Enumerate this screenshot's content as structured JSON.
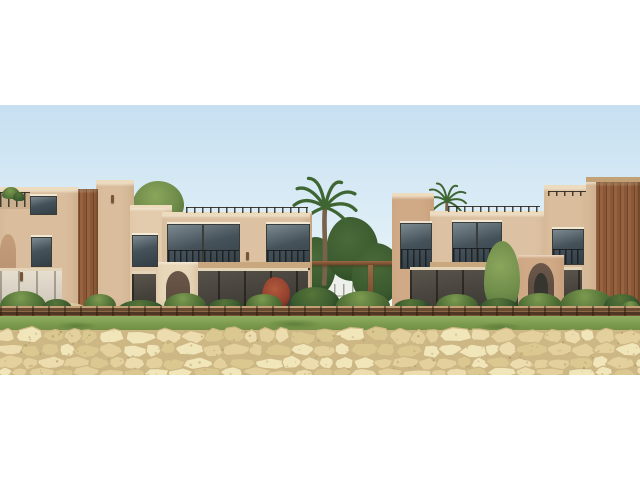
{
  "photo": {
    "description": "Architectural exterior rendering of a row of two-storey sandstone beach villas with arched doorways, dark framed balcony windows, palm trees and desert shrubs, a timber boardwalk rail, a grass verge and a natural polygonal stone retaining wall in the foreground under a pale blue sky",
    "width_px": 640,
    "height_px": 270,
    "top_offset_px": 105
  },
  "scene": {
    "elements": [
      "sky",
      "left-villa-block",
      "rooftop-terrace-plants",
      "timber-entry-panel",
      "center-villa-block",
      "rooftop-railing",
      "balcony-windows",
      "ground-floor-glazing",
      "arched-doorway",
      "tall-palm-tree",
      "rooftop-palm-tree",
      "garden-pergola",
      "distant-white-fence",
      "right-villa-block",
      "rear-villa",
      "wood-slat-tower",
      "garden-shrubs",
      "red-flowering-shrub",
      "sand-mound",
      "timber-boardwalk-rail",
      "grass-verge",
      "stone-retaining-wall"
    ]
  },
  "palette": {
    "page_bg": "#ffffff",
    "sky_top": "#c6dff1",
    "sky_mid": "#dcedf6",
    "sky_bottom": "#f0f6f9",
    "wall_light": "#e3ccad",
    "wall_mid": "#d9bd9c",
    "wall_mid2": "#dcc2a2",
    "wall_dark": "#d0a986",
    "wall_cream": "#e8d7b9",
    "coping": "#ecdbbc",
    "slab": "#c9a87f",
    "arch_recess": "#c49e7b",
    "arch_inner": "#6b584a",
    "door_dark": "#37352f",
    "wood": "#8a5838",
    "wood_dark": "#70452a",
    "window_glass": "#46525a",
    "window_glass_hi": "#7b8990",
    "window_frame": "#3a3c39",
    "glass_low": "#44403a",
    "curtain": "#d4cdbf",
    "green_dark": "#3c5c30",
    "green_mid": "#557539",
    "green_light": "#7d9a50",
    "olive": "#6f8c4a",
    "palm_green": "#3f6632",
    "trunk": "#77624a",
    "grass": "#7d9b4e",
    "grass_dark": "#5f7f3b",
    "rail_top": "#c2a177",
    "rail_wood": "#6b4c32",
    "rail_shadow": "#4e3622",
    "sand": "#d8c29a",
    "stone_joint": "#cdb785",
    "stone_1": "#ecdcae",
    "stone_2": "#e3d09c",
    "stone_3": "#f1e5ba",
    "stone_4": "#dbc891",
    "speckle": "#8c7437",
    "rock_gray": "#9b8a6d",
    "distant_fence": "#eef0ea",
    "plant_red": "#93402e"
  }
}
